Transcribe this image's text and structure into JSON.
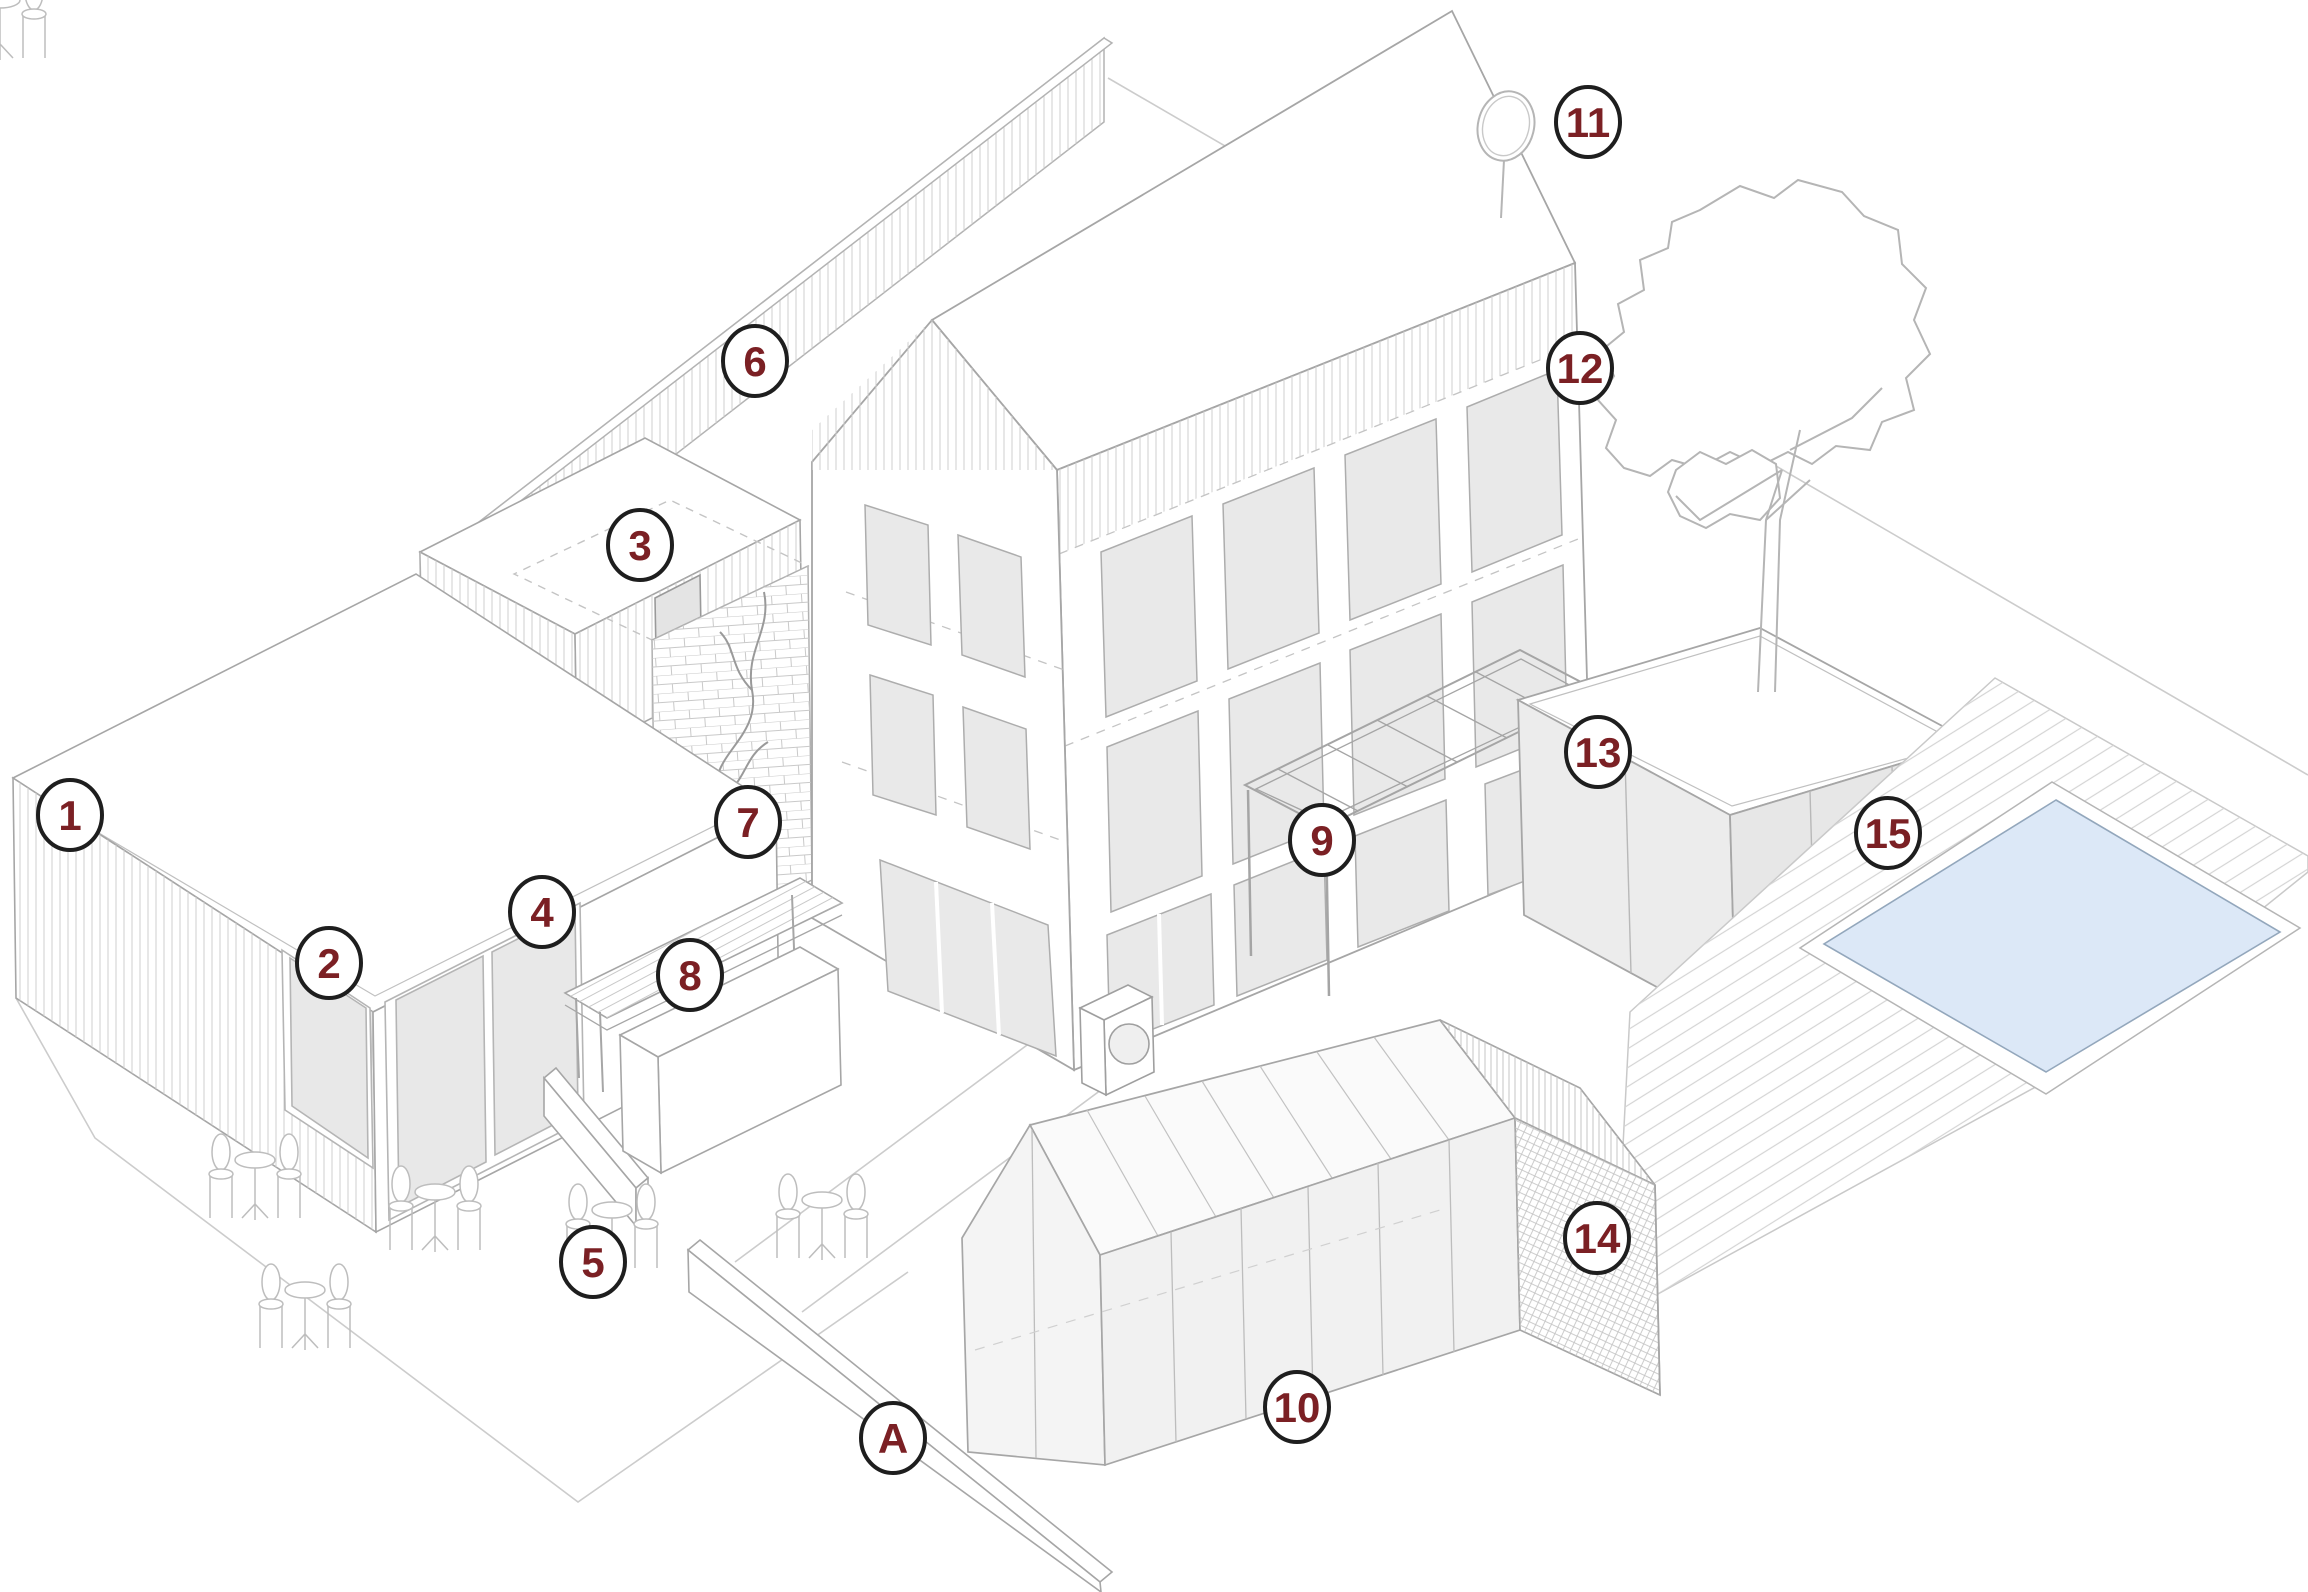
{
  "document": {
    "type": "axonometric-site-plan",
    "background": "#ffffff"
  },
  "palette": {
    "marker_text": "#7b2024",
    "marker_border": "#1e1e1e",
    "marker_fill": "#ffffff",
    "line": "#a6a6a6",
    "hatch": "#cfcfcf",
    "glass": "#e8e8e8",
    "water": "#dce8f7",
    "water_edge": "#93a7bc"
  },
  "markers": [
    {
      "label": "1",
      "x": 70,
      "y": 815
    },
    {
      "label": "2",
      "x": 329,
      "y": 963
    },
    {
      "label": "3",
      "x": 640,
      "y": 545
    },
    {
      "label": "4",
      "x": 542,
      "y": 912
    },
    {
      "label": "5",
      "x": 593,
      "y": 1262
    },
    {
      "label": "6",
      "x": 755,
      "y": 361
    },
    {
      "label": "7",
      "x": 748,
      "y": 822
    },
    {
      "label": "8",
      "x": 690,
      "y": 975
    },
    {
      "label": "9",
      "x": 1322,
      "y": 840
    },
    {
      "label": "10",
      "x": 1297,
      "y": 1407
    },
    {
      "label": "11",
      "x": 1588,
      "y": 122
    },
    {
      "label": "12",
      "x": 1580,
      "y": 368
    },
    {
      "label": "13",
      "x": 1598,
      "y": 752
    },
    {
      "label": "14",
      "x": 1597,
      "y": 1238
    },
    {
      "label": "15",
      "x": 1888,
      "y": 833
    },
    {
      "label": "A",
      "x": 893,
      "y": 1438
    }
  ]
}
